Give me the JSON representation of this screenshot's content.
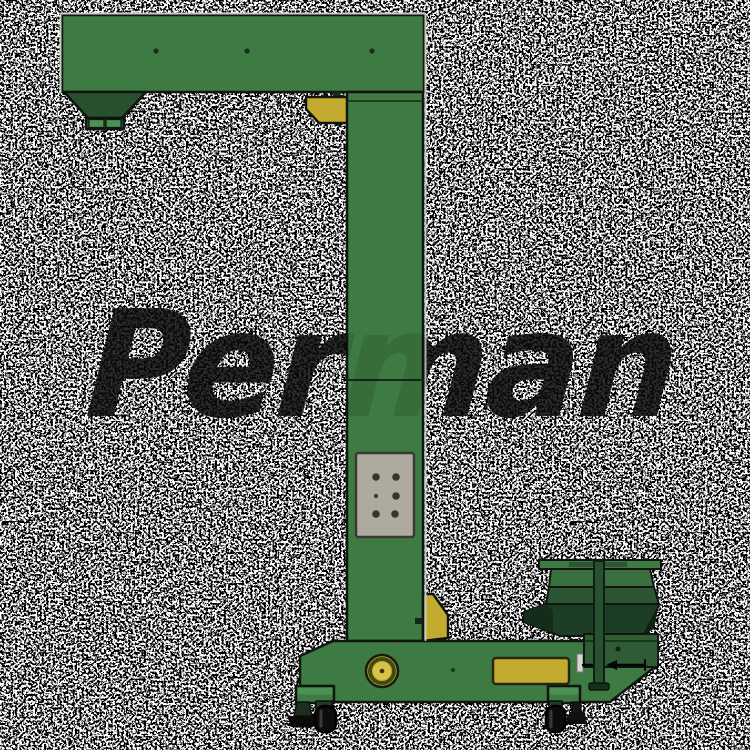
{
  "watermark": {
    "text": "Perman"
  },
  "colors": {
    "background": "#ffffff",
    "noise_dot": "#060606",
    "green_main": "#3e7b43",
    "green_dark": "#27512e",
    "green_darker": "#1d3d24",
    "green_band": "#2b5533",
    "green_light": "#4c9055",
    "yellow": "#c2ab2e",
    "yellow_bright": "#d6c347",
    "gray_plate": "#aeaaa0",
    "gray_bracket": "#d8d8d2",
    "outline": "#101510",
    "wheel_black": "#0c0c0c"
  }
}
